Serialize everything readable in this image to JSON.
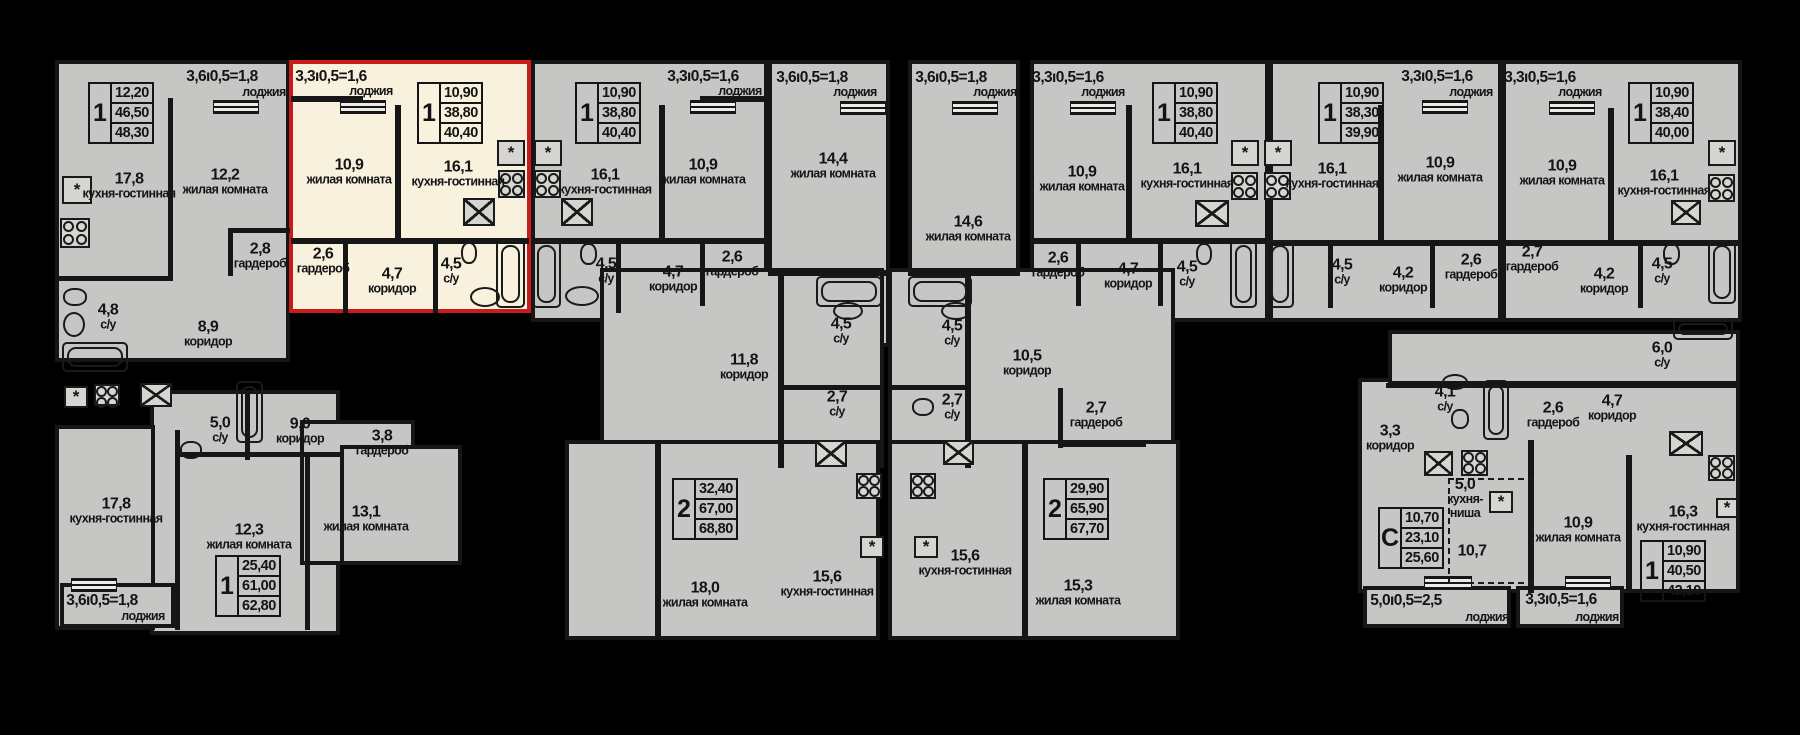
{
  "meta": {
    "type": "residential-floor-plan",
    "language": "ru"
  },
  "colors": {
    "background": "#000000",
    "floor_fill": "#c6c6c4",
    "wall": "#161616",
    "highlight_fill": "#f7f1de",
    "highlight_border": "#cb1a1a",
    "text": "#141414"
  },
  "selected_apartment": {
    "rect": [
      289,
      60,
      242,
      253
    ],
    "info": {
      "type": "1",
      "values": [
        "10,90",
        "38,80",
        "40,40"
      ]
    }
  },
  "strings": {
    "loggia_word": "лоджия"
  },
  "sections": [
    [
      55,
      60,
      235,
      302
    ],
    [
      150,
      390,
      190,
      245
    ],
    [
      55,
      425,
      100,
      205
    ],
    [
      300,
      420,
      115,
      145
    ],
    [
      340,
      445,
      122,
      120
    ],
    [
      60,
      583,
      115,
      45
    ],
    [
      531,
      60,
      237,
      262
    ],
    [
      768,
      60,
      122,
      287
    ],
    [
      908,
      60,
      112,
      287
    ],
    [
      1030,
      60,
      239,
      262
    ],
    [
      1269,
      60,
      233,
      262
    ],
    [
      1502,
      60,
      240,
      262
    ],
    [
      600,
      268,
      284,
      200
    ],
    [
      565,
      440,
      315,
      200
    ],
    [
      888,
      268,
      287,
      200
    ],
    [
      888,
      440,
      292,
      200
    ],
    [
      1358,
      378,
      382,
      215
    ],
    [
      1388,
      330,
      352,
      55
    ],
    [
      1363,
      586,
      148,
      42
    ],
    [
      1516,
      586,
      108,
      42
    ]
  ],
  "walls": [
    [
      168,
      98,
      5,
      182
    ],
    [
      55,
      276,
      118,
      5
    ],
    [
      228,
      228,
      62,
      5
    ],
    [
      228,
      228,
      5,
      48
    ],
    [
      245,
      390,
      5,
      70
    ],
    [
      180,
      452,
      160,
      5
    ],
    [
      175,
      430,
      5,
      200
    ],
    [
      305,
      452,
      5,
      178
    ],
    [
      291,
      96,
      72,
      6
    ],
    [
      395,
      105,
      6,
      138
    ],
    [
      291,
      238,
      238,
      6
    ],
    [
      343,
      244,
      5,
      69
    ],
    [
      433,
      244,
      5,
      69
    ],
    [
      659,
      105,
      6,
      136
    ],
    [
      533,
      238,
      233,
      6
    ],
    [
      616,
      244,
      5,
      69
    ],
    [
      700,
      244,
      5,
      62
    ],
    [
      700,
      96,
      68,
      6
    ],
    [
      768,
      270,
      122,
      6
    ],
    [
      908,
      270,
      112,
      6
    ],
    [
      1126,
      105,
      6,
      136
    ],
    [
      1030,
      238,
      239,
      6
    ],
    [
      1076,
      244,
      5,
      62
    ],
    [
      1158,
      244,
      5,
      62
    ],
    [
      1378,
      105,
      6,
      136
    ],
    [
      1272,
      240,
      230,
      6
    ],
    [
      1328,
      246,
      5,
      62
    ],
    [
      1430,
      246,
      5,
      62
    ],
    [
      1608,
      108,
      6,
      134
    ],
    [
      1504,
      240,
      236,
      6
    ],
    [
      1638,
      246,
      5,
      62
    ],
    [
      778,
      268,
      6,
      200
    ],
    [
      780,
      385,
      104,
      5
    ],
    [
      655,
      440,
      6,
      200
    ],
    [
      965,
      268,
      6,
      200
    ],
    [
      888,
      385,
      80,
      5
    ],
    [
      1058,
      388,
      5,
      60
    ],
    [
      1058,
      442,
      88,
      5
    ],
    [
      1022,
      440,
      6,
      200
    ],
    [
      1386,
      383,
      354,
      5
    ],
    [
      1528,
      440,
      6,
      153
    ],
    [
      1626,
      455,
      6,
      138
    ]
  ],
  "rails": [
    [
      213,
      100,
      44,
      12
    ],
    [
      340,
      100,
      44,
      12
    ],
    [
      690,
      100,
      44,
      12
    ],
    [
      840,
      101,
      44,
      12
    ],
    [
      952,
      101,
      44,
      12
    ],
    [
      1070,
      101,
      44,
      12
    ],
    [
      1422,
      100,
      44,
      12
    ],
    [
      1549,
      101,
      44,
      12
    ],
    [
      71,
      578,
      44,
      12
    ],
    [
      1424,
      576,
      46,
      12
    ],
    [
      1565,
      576,
      44,
      12
    ]
  ],
  "kitchen_niche_dashed_rect": [
    1448,
    478,
    86,
    106
  ],
  "room_labels": [
    [
      129,
      186,
      "17,8",
      "кухня-гостинная"
    ],
    [
      225,
      182,
      "12,2",
      "жилая комната"
    ],
    [
      260,
      256,
      "2,8",
      "гардероб"
    ],
    [
      108,
      317,
      "4,8",
      "с/у"
    ],
    [
      208,
      334,
      "8,9",
      "коридор"
    ],
    [
      220,
      430,
      "5,0",
      "с/у"
    ],
    [
      300,
      431,
      "9,0",
      "коридор"
    ],
    [
      382,
      443,
      "3,8",
      "гардероб"
    ],
    [
      116,
      511,
      "17,8",
      "кухня-гостинная"
    ],
    [
      249,
      537,
      "12,3",
      "жилая комната"
    ],
    [
      366,
      519,
      "13,1",
      "жилая комната"
    ],
    [
      349,
      172,
      "10,9",
      "жилая комната"
    ],
    [
      458,
      174,
      "16,1",
      "кухня-гостинная"
    ],
    [
      323,
      261,
      "2,6",
      "гардероб"
    ],
    [
      392,
      281,
      "4,7",
      "коридор"
    ],
    [
      451,
      271,
      "4,5",
      "с/у"
    ],
    [
      605,
      182,
      "16,1",
      "кухня-гостинная"
    ],
    [
      703,
      172,
      "10,9",
      "жилая комната"
    ],
    [
      606,
      271,
      "4,5",
      "с/у"
    ],
    [
      673,
      279,
      "4,7",
      "коридор"
    ],
    [
      732,
      264,
      "2,6",
      "гардероб"
    ],
    [
      833,
      166,
      "14,4",
      "жилая комната"
    ],
    [
      968,
      229,
      "14,6",
      "жилая комната"
    ],
    [
      841,
      331,
      "4,5",
      "с/у"
    ],
    [
      952,
      333,
      "4,5",
      "с/у"
    ],
    [
      1082,
      179,
      "10,9",
      "жилая комната"
    ],
    [
      1187,
      176,
      "16,1",
      "кухня-гостинная"
    ],
    [
      1058,
      265,
      "2,6",
      "гардероб"
    ],
    [
      1128,
      276,
      "4,7",
      "коридор"
    ],
    [
      1187,
      274,
      "4,5",
      "с/у"
    ],
    [
      1332,
      176,
      "16,1",
      "кухня-гостинная"
    ],
    [
      1440,
      170,
      "10,9",
      "жилая комната"
    ],
    [
      1342,
      272,
      "4,5",
      "с/у"
    ],
    [
      1403,
      280,
      "4,2",
      "коридор"
    ],
    [
      1471,
      267,
      "2,6",
      "гардероб"
    ],
    [
      1562,
      173,
      "10,9",
      "жилая комната"
    ],
    [
      1664,
      183,
      "16,1",
      "кухня-гостинная"
    ],
    [
      1532,
      259,
      "2,7",
      "гардероб"
    ],
    [
      1604,
      281,
      "4,2",
      "коридор"
    ],
    [
      1662,
      271,
      "4,5",
      "с/у"
    ],
    [
      744,
      367,
      "11,8",
      "коридор"
    ],
    [
      837,
      404,
      "2,7",
      "с/у"
    ],
    [
      705,
      595,
      "18,0",
      "жилая комната"
    ],
    [
      827,
      584,
      "15,6",
      "кухня-гостинная"
    ],
    [
      1027,
      363,
      "10,5",
      "коридор"
    ],
    [
      952,
      407,
      "2,7",
      "с/у"
    ],
    [
      1096,
      415,
      "2,7",
      "гардероб"
    ],
    [
      965,
      563,
      "15,6",
      "кухня-гостинная"
    ],
    [
      1078,
      593,
      "15,3",
      "жилая комната"
    ],
    [
      1390,
      438,
      "3,3",
      "коридор"
    ],
    [
      1445,
      399,
      "4,1",
      "с/у"
    ],
    [
      1465,
      498,
      "5,0",
      "кухня-\nниша"
    ],
    [
      1472,
      551,
      "10,7",
      ""
    ],
    [
      1553,
      415,
      "2,6",
      "гардероб"
    ],
    [
      1612,
      408,
      "4,7",
      "коридор"
    ],
    [
      1662,
      355,
      "6,0",
      "с/у"
    ],
    [
      1578,
      530,
      "10,9",
      "жилая комната"
    ],
    [
      1683,
      519,
      "16,3",
      "кухня-гостинная"
    ]
  ],
  "info_boxes": [
    [
      88,
      82,
      "1",
      "12,20",
      "46,50",
      "48,30"
    ],
    [
      417,
      82,
      "1",
      "10,90",
      "38,80",
      "40,40"
    ],
    [
      575,
      82,
      "1",
      "10,90",
      "38,80",
      "40,40"
    ],
    [
      1152,
      82,
      "1",
      "10,90",
      "38,80",
      "40,40"
    ],
    [
      1318,
      82,
      "1",
      "10,90",
      "38,30",
      "39,90"
    ],
    [
      1628,
      82,
      "1",
      "10,90",
      "38,40",
      "40,00"
    ],
    [
      215,
      555,
      "1",
      "25,40",
      "61,00",
      "62,80"
    ],
    [
      672,
      478,
      "2",
      "32,40",
      "67,00",
      "68,80"
    ],
    [
      1043,
      478,
      "2",
      "29,90",
      "65,90",
      "67,70"
    ],
    [
      1378,
      507,
      "С",
      "10,70",
      "23,10",
      "25,60"
    ],
    [
      1640,
      540,
      "1",
      "10,90",
      "40,50",
      "42,10"
    ]
  ],
  "loggia_labels": [
    [
      222,
      77,
      264,
      92,
      "3,6ı0,5=1,8"
    ],
    [
      331,
      77,
      371,
      91,
      "3,3ı0,5=1,6"
    ],
    [
      703,
      77,
      740,
      91,
      "3,3ı0,5=1,6"
    ],
    [
      812,
      78,
      855,
      92,
      "3,6ı0,5=1,8"
    ],
    [
      951,
      78,
      995,
      92,
      "3,6ı0,5=1,8"
    ],
    [
      1068,
      78,
      1103,
      92,
      "3,3ı0,5=1,6"
    ],
    [
      1437,
      77,
      1471,
      92,
      "3,3ı0,5=1,6"
    ],
    [
      1540,
      78,
      1580,
      92,
      "3,3ı0,5=1,6"
    ],
    [
      102,
      601,
      143,
      616,
      "3,6ı0,5=1,8"
    ],
    [
      1406,
      601,
      1487,
      617,
      "5,0ı0,5=2,5"
    ],
    [
      1561,
      600,
      1597,
      617,
      "3,3ı0,5=1,6"
    ]
  ],
  "fixtures": [
    [
      "star",
      62,
      176,
      30,
      28
    ],
    [
      "star",
      497,
      140,
      28,
      26
    ],
    [
      "star",
      534,
      140,
      28,
      26
    ],
    [
      "star",
      1231,
      140,
      28,
      26
    ],
    [
      "star",
      1264,
      140,
      28,
      26
    ],
    [
      "star",
      1708,
      140,
      28,
      26
    ],
    [
      "star",
      64,
      386,
      24,
      22
    ],
    [
      "star",
      860,
      536,
      24,
      22
    ],
    [
      "star",
      914,
      536,
      24,
      22
    ],
    [
      "star",
      1489,
      491,
      24,
      22
    ],
    [
      "star",
      1716,
      498,
      22,
      20
    ],
    [
      "stove",
      60,
      218,
      30,
      30
    ],
    [
      "stove",
      498,
      170,
      27,
      28
    ],
    [
      "stove",
      534,
      170,
      27,
      28
    ],
    [
      "stove",
      1231,
      172,
      27,
      28
    ],
    [
      "stove",
      1264,
      172,
      27,
      28
    ],
    [
      "stove",
      1708,
      174,
      27,
      28
    ],
    [
      "stove",
      94,
      384,
      26,
      22
    ],
    [
      "stove",
      856,
      473,
      26,
      26
    ],
    [
      "stove",
      910,
      473,
      26,
      26
    ],
    [
      "stove",
      1461,
      450,
      27,
      26
    ],
    [
      "stove",
      1708,
      455,
      27,
      26
    ],
    [
      "ksink",
      463,
      198,
      32,
      28
    ],
    [
      "ksink",
      561,
      198,
      32,
      28
    ],
    [
      "ksink",
      1195,
      200,
      34,
      27
    ],
    [
      "ksink",
      1671,
      200,
      30,
      25
    ],
    [
      "ksink",
      815,
      440,
      32,
      27
    ],
    [
      "ksink",
      943,
      440,
      31,
      25
    ],
    [
      "ksink",
      1424,
      451,
      29,
      25
    ],
    [
      "ksink",
      1669,
      431,
      34,
      25
    ],
    [
      "ksink",
      140,
      383,
      32,
      24
    ],
    [
      "bath",
      62,
      342,
      66,
      30
    ],
    [
      "bath",
      236,
      381,
      27,
      62
    ],
    [
      "bath",
      496,
      240,
      29,
      68
    ],
    [
      "bath",
      532,
      240,
      29,
      68
    ],
    [
      "bath",
      816,
      276,
      66,
      31
    ],
    [
      "bath",
      908,
      276,
      64,
      31
    ],
    [
      "bath",
      1230,
      240,
      27,
      68
    ],
    [
      "bath",
      1266,
      240,
      28,
      68
    ],
    [
      "bath",
      1708,
      240,
      28,
      64
    ],
    [
      "bath",
      1483,
      380,
      26,
      60
    ],
    [
      "bath",
      1673,
      318,
      60,
      22
    ],
    [
      "wc",
      461,
      242,
      16,
      22
    ],
    [
      "wc",
      580,
      243,
      17,
      22
    ],
    [
      "wc",
      1196,
      243,
      16,
      22
    ],
    [
      "wc",
      1663,
      243,
      17,
      22
    ],
    [
      "wc",
      63,
      288,
      24,
      18
    ],
    [
      "wc",
      180,
      441,
      22,
      18
    ],
    [
      "wc",
      1451,
      409,
      18,
      20
    ],
    [
      "wc",
      912,
      398,
      22,
      18
    ],
    [
      "bsink",
      470,
      287,
      30,
      20
    ],
    [
      "bsink",
      565,
      286,
      34,
      20
    ],
    [
      "bsink",
      63,
      312,
      22,
      25
    ],
    [
      "bsink",
      833,
      302,
      30,
      18
    ],
    [
      "bsink",
      941,
      302,
      30,
      18
    ],
    [
      "bsink",
      1442,
      374,
      26,
      16
    ]
  ]
}
